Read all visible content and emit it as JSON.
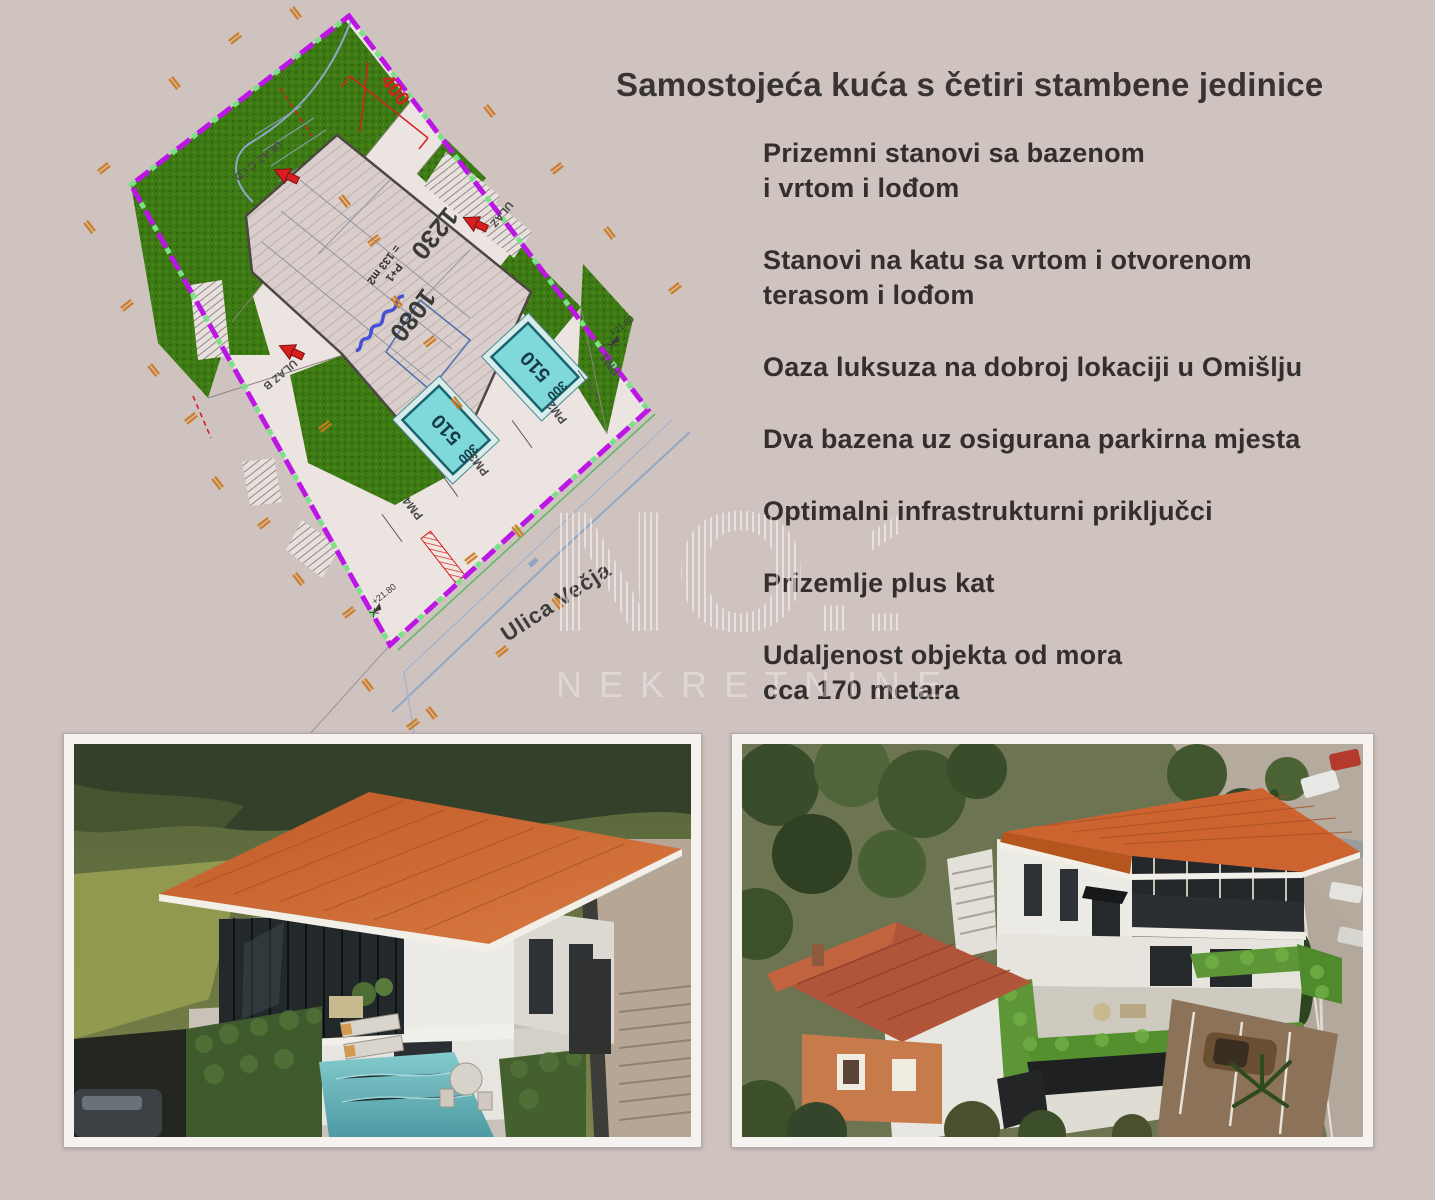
{
  "page": {
    "background_color": "#cfc3c0"
  },
  "headline": {
    "title": "Samostojeća kuća s četiri stambene jedinice"
  },
  "features": [
    "Prizemni stanovi sa bazenom\ni vrtom i lođom",
    "Stanovi na katu sa vrtom i otvorenom\nterasom i lođom",
    "Oaza luksuza na dobroj lokaciji u Omišlju",
    "Dva bazena uz osigurana parkirna mjesta",
    "Optimalni infrastrukturni priključci",
    "Prizemlje plus kat",
    "Udaljenost objekta od mora\ncca 170 metara"
  ],
  "watermark": {
    "line1": "NO.1",
    "line2": "NEKRETNINE"
  },
  "site_plan": {
    "street_label": "Ulica Večja",
    "dim_top": "400",
    "dim_width": "1230",
    "dim_depth": "1080",
    "area_label_line1": "P+1",
    "area_label_line2": "= 133 m2",
    "pool_length": "510",
    "pool_width": "300",
    "entrance_cd": "ULAZ C i D",
    "entrance_b": "ULAZ B",
    "entrance_right": "ULAZ",
    "parking": [
      "PM1",
      "PM2",
      "PM3",
      "PM4"
    ],
    "elevation_mark": "+21.80",
    "colors": {
      "boundary": "#bb16e6",
      "garden_green": "#3d7a13",
      "pool_cyan": "#7fd9da",
      "accent_red": "#d42020",
      "dim_orange": "#cf7a1e"
    }
  },
  "photos": {
    "roof_color": "#cd6430",
    "hedge_color": "#5d9636"
  }
}
